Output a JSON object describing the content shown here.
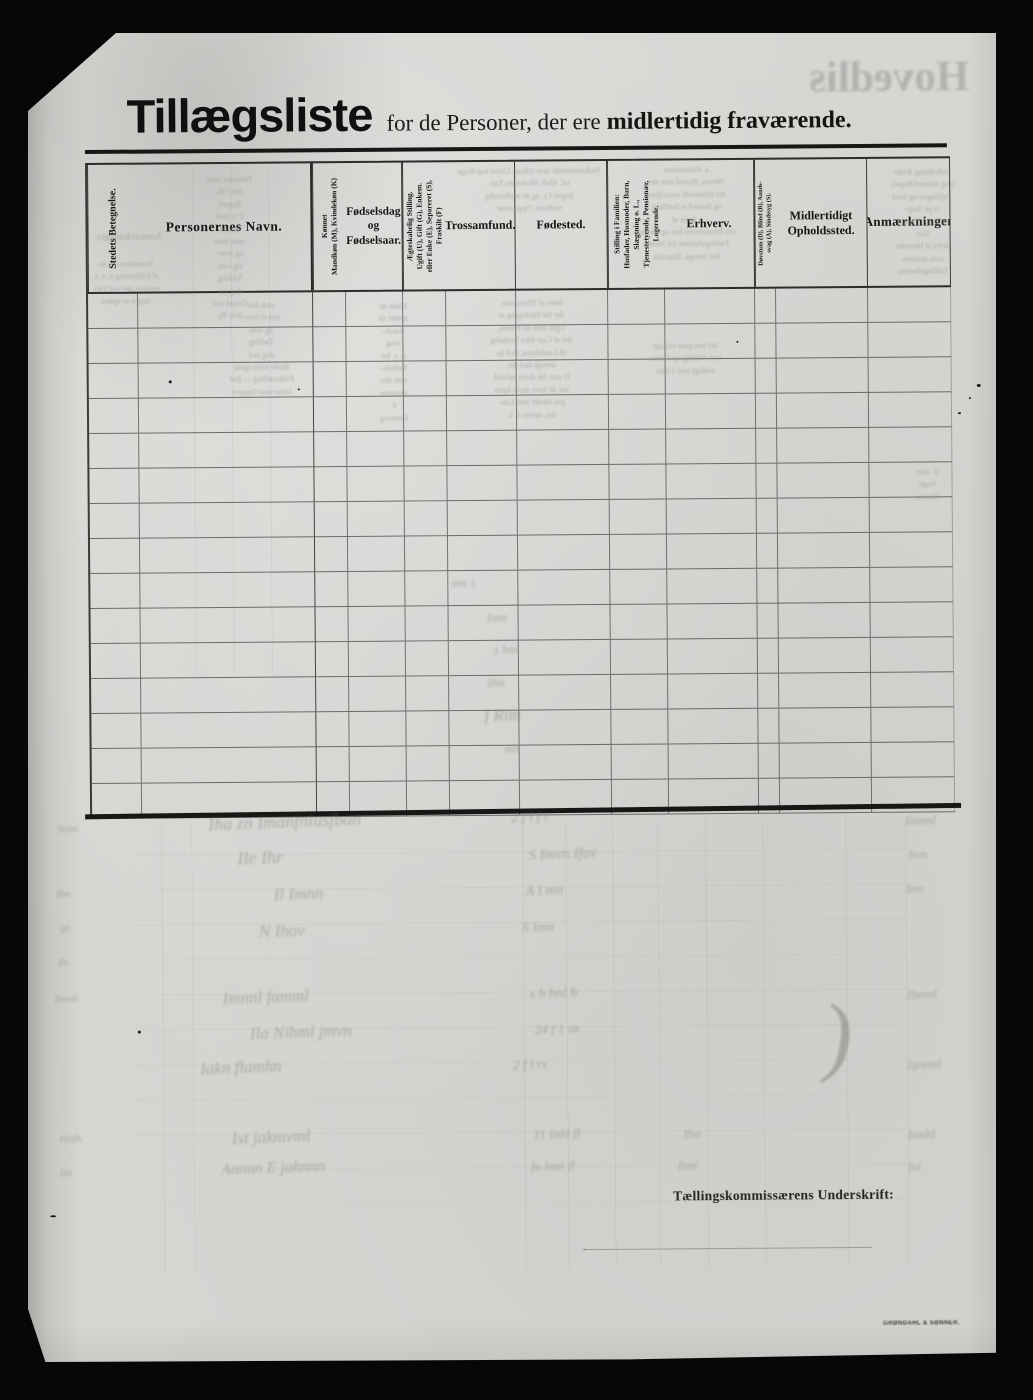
{
  "document": {
    "title": "Tillægsliste",
    "subtitle_regular": "for de Personer, der ere",
    "subtitle_bold": "midlertidig fraværende.",
    "footer": {
      "signature_label": "Tællingskommissærens Underskrift:",
      "printer_imprint": "GRØNDAHL & SØNNER."
    }
  },
  "table": {
    "body_rows": 15,
    "columns": [
      {
        "id": "stedets-betegnelse",
        "label": "Stedets Betegnelse."
      },
      {
        "id": "personernes-navn",
        "label": "Personernes Navn."
      },
      {
        "id": "kjonnet",
        "label": "Kønnet\nMandkøn (M), Kvindekøn (K)"
      },
      {
        "id": "fodselsdag",
        "label": "Fødselsdag\nog\nFødselsaar."
      },
      {
        "id": "aegteskabelig-stilling",
        "label": "Ægteskabelig Stilling.\nUgift (U), Gift (G), Enkem.\neller Enke (E), Separeret (S),\nFraskilt (F)"
      },
      {
        "id": "trossamfund",
        "label": "Trossamfund."
      },
      {
        "id": "fodested",
        "label": "Fødested."
      },
      {
        "id": "stilling-i-familien",
        "label": "Stilling i Familien:\nHusfader, Husmoder, Barn,\nSlægtning o. L.,\nTjenestetyende, Pensionær,\nLogerende."
      },
      {
        "id": "erhverv",
        "label": "Erhverv."
      },
      {
        "id": "dovstum",
        "label": "Døvstum (D), Blind (B), Aands-\nsvag (A), Sindssyg (S)."
      },
      {
        "id": "midlertidigt-opholdssted",
        "label": "Midlertidigt\nOpholdssted."
      },
      {
        "id": "anmaerkninger",
        "label": "Anmærkninger"
      }
    ]
  },
  "ghosts": {
    "big_mirrored_title": "Hovedliste",
    "blocks": [
      {
        "x": 122,
        "y": 142,
        "w": 158,
        "s": 8,
        "lines": [
          "Personer, som",
          "den Tid,",
          "Bopæl,",
          "f. v. med",
          "bosted",
          "som Sted",
          "og over-",
          "sig ved-",
          "Tælling",
          "dog om",
          "Grund ved",
          "dens By"
        ]
      },
      {
        "x": 40,
        "y": 196,
        "w": 120,
        "s": 11,
        "lines": [
          "Anmærkninger."
        ]
      },
      {
        "x": 38,
        "y": 226,
        "w": 118,
        "s": 8,
        "lines": [
          "Fornødent om de",
          "af Udflytning o. s. v.",
          "medens der ved Tæl-",
          "lingen er opført"
        ]
      },
      {
        "x": 168,
        "y": 268,
        "w": 128,
        "s": 8,
        "lines": [
          "som den",
          "nys er bort-",
          "og som",
          "Tælling",
          "dog ved",
          "Rinfo  Alen  ogsaa",
          "Folketælling  —  Del",
          "bleve  som  Opgave"
        ]
      },
      {
        "x": 318,
        "y": 270,
        "w": 92,
        "s": 8,
        "lines": [
          "Blade  de",
          "opføre  de",
          "Aands-",
          "svag",
          "d. v. for",
          "Fødsels-",
          "som  den",
          "sæsonen",
          "d.",
          "Førsteog"
        ]
      },
      {
        "x": 420,
        "y": 136,
        "w": 162,
        "s": 8,
        "lines": [
          "Vedkommende  dem  vilkaar  Listen  kan  Regn",
          "taf.  Midl.  Skolebørn  Tæl-",
          "lingen  f  s.  og  de  midlertidig",
          "vedkom.  Opgaverne"
        ]
      },
      {
        "x": 418,
        "y": 268,
        "w": 168,
        "s": 8,
        "lines": [
          "Børn  af  Tilreisende,",
          "der  for  Skolegang  er",
          "Ugift  eller  en  Person,",
          "der  af  Gaar  blev  henhørig",
          "til  Landsbyen,  hvil  ke",
          "iøvrigt  skal  der",
          "Ti  som  for  deres  ophold,",
          "bør  de  have  deres  hjem",
          "paa  Steder  som  Lan-",
          "det,  nævnt  d.  s."
        ]
      },
      {
        "x": 588,
        "y": 136,
        "w": 140,
        "s": 8,
        "lines": [
          "a.  Kolonnerne",
          "Skema,  Bosted  som  der",
          "der  tilhørende  mest  hjem",
          "og  Bosted  er  bortfaldt",
          "i  Byen  af",
          "om  Personernes  hos  og  Skema",
          "Tællingslisterne  fra  Skema",
          "Det  betegn.  Distrikts"
        ]
      },
      {
        "x": 592,
        "y": 312,
        "w": 128,
        "s": 8,
        "lines": [
          "der  betegnet  vedlagt",
          "som  Stilling  og  Skema",
          "vedlagt  som  Lister"
        ]
      },
      {
        "x": 838,
        "y": 140,
        "w": 112,
        "s": 8,
        "lines": [
          "Indledning,  Kirke",
          "a  og  dermed  Bopæl,",
          "Tællingen  og  Sted",
          "er  pr.  Sogn",
          "Stilling  i  Famil-",
          "Den",
          "deles  af  Herredet",
          "som  opførtes",
          "Tællingslisterne"
        ]
      },
      {
        "x": 852,
        "y": 440,
        "w": 90,
        "s": 8,
        "lines": [
          "d.  Ann",
          "Sogn",
          "Skema"
        ]
      }
    ],
    "strokes": [
      {
        "x": 175,
        "y": 780,
        "t": "Iha  zn  Imanfnlusfban",
        "s": 18
      },
      {
        "x": 478,
        "y": 781,
        "t": "2   f  l  f  r",
        "s": 14
      },
      {
        "x": 872,
        "y": 786,
        "t": "Imnnl",
        "s": 13
      },
      {
        "x": 204,
        "y": 816,
        "t": "Ile    Ihr",
        "s": 18
      },
      {
        "x": 495,
        "y": 817,
        "t": "S  Imvn   Ifov",
        "s": 15
      },
      {
        "x": 875,
        "y": 820,
        "t": "hvn",
        "s": 13
      },
      {
        "x": 240,
        "y": 853,
        "t": "Il   Imnn",
        "s": 17
      },
      {
        "x": 492,
        "y": 854,
        "t": "A   I mn",
        "s": 14
      },
      {
        "x": 872,
        "y": 855,
        "t": "Snn",
        "s": 12
      },
      {
        "x": 225,
        "y": 890,
        "t": "N    Ihov",
        "s": 17
      },
      {
        "x": 488,
        "y": 891,
        "t": "S  Imn",
        "s": 14
      },
      {
        "x": 420,
        "y": 545,
        "t": "mn  s",
        "s": 13
      },
      {
        "x": 455,
        "y": 580,
        "t": "Imn",
        "s": 13
      },
      {
        "x": 462,
        "y": 612,
        "t": "s hm",
        "s": 13
      },
      {
        "x": 455,
        "y": 645,
        "t": "Ihn",
        "s": 13
      },
      {
        "x": 452,
        "y": 676,
        "t": "f   Rim",
        "s": 17
      },
      {
        "x": 472,
        "y": 712,
        "t": "mn",
        "s": 12
      },
      {
        "x": 188,
        "y": 956,
        "t": "Imnnl    famml",
        "s": 17
      },
      {
        "x": 495,
        "y": 957,
        "t": "s  h  bnl   h",
        "s": 14
      },
      {
        "x": 872,
        "y": 960,
        "t": "Ibmnl",
        "s": 13
      },
      {
        "x": 215,
        "y": 991,
        "t": "Ila   Nihml   jmvn",
        "s": 17
      },
      {
        "x": 500,
        "y": 992,
        "t": "24 f  1 sn",
        "s": 13
      },
      {
        "x": 165,
        "y": 1026,
        "t": "Iakn     flamhn",
        "s": 17
      },
      {
        "x": 478,
        "y": 1027,
        "t": "2 f   l  rx",
        "s": 13
      },
      {
        "x": 872,
        "y": 1030,
        "t": "Ignnnl",
        "s": 13
      },
      {
        "x": 196,
        "y": 1096,
        "t": "Ist     jakmvml",
        "s": 17
      },
      {
        "x": 498,
        "y": 1097,
        "t": "11 Inhl   fl",
        "s": 13
      },
      {
        "x": 648,
        "y": 1098,
        "t": "Ihn",
        "s": 13
      },
      {
        "x": 872,
        "y": 1100,
        "t": "Innhl",
        "s": 13
      },
      {
        "x": 185,
        "y": 1128,
        "t": "Antmn  E   jahnnn",
        "s": 16
      },
      {
        "x": 495,
        "y": 1129,
        "t": "fn Imn   fl",
        "s": 13
      },
      {
        "x": 642,
        "y": 1130,
        "t": "Ihnl",
        "s": 12
      },
      {
        "x": 872,
        "y": 1133,
        "t": "Inl",
        "s": 12
      },
      {
        "x": 24,
        "y": 790,
        "t": "Nnm",
        "s": 11
      },
      {
        "x": 22,
        "y": 855,
        "t": "Ihn",
        "s": 11
      },
      {
        "x": 26,
        "y": 890,
        "t": "gn",
        "s": 10
      },
      {
        "x": 24,
        "y": 925,
        "t": "Ps",
        "s": 10
      },
      {
        "x": 20,
        "y": 960,
        "t": "Ihnnl",
        "s": 11
      },
      {
        "x": 24,
        "y": 1100,
        "t": "Hnfh",
        "s": 11
      },
      {
        "x": 24,
        "y": 1134,
        "t": "Iln",
        "s": 11
      },
      {
        "x": 788,
        "y": 958,
        "t": ")",
        "s": 88
      }
    ],
    "lines": [
      {
        "x": 164,
        "y": 135,
        "w": 1,
        "h": 505,
        "o": 0.1
      },
      {
        "x": 202,
        "y": 135,
        "w": 1,
        "h": 505,
        "o": 0.1
      },
      {
        "x": 240,
        "y": 135,
        "w": 1,
        "h": 505,
        "o": 0.09
      },
      {
        "x": 128,
        "y": 790,
        "w": 1,
        "h": 450,
        "o": 0.1
      },
      {
        "x": 158,
        "y": 790,
        "w": 1,
        "h": 450,
        "o": 0.08
      },
      {
        "x": 489,
        "y": 790,
        "w": 1,
        "h": 450,
        "o": 0.11
      },
      {
        "x": 532,
        "y": 790,
        "w": 1,
        "h": 450,
        "o": 0.09
      },
      {
        "x": 579,
        "y": 790,
        "w": 1,
        "h": 450,
        "o": 0.1
      },
      {
        "x": 624,
        "y": 790,
        "w": 1,
        "h": 450,
        "o": 0.08
      },
      {
        "x": 672,
        "y": 790,
        "w": 1,
        "h": 450,
        "o": 0.09
      },
      {
        "x": 729,
        "y": 790,
        "w": 1,
        "h": 450,
        "o": 0.08
      },
      {
        "x": 812,
        "y": 790,
        "w": 1,
        "h": 450,
        "o": 0.09
      },
      {
        "x": 872,
        "y": 790,
        "w": 1,
        "h": 450,
        "o": 0.08
      },
      {
        "x": 100,
        "y": 822,
        "w": 772,
        "h": 1,
        "o": 0.07
      },
      {
        "x": 100,
        "y": 857,
        "w": 772,
        "h": 1,
        "o": 0.07
      },
      {
        "x": 100,
        "y": 892,
        "w": 772,
        "h": 1,
        "o": 0.07
      },
      {
        "x": 100,
        "y": 927,
        "w": 772,
        "h": 1,
        "o": 0.06
      },
      {
        "x": 100,
        "y": 962,
        "w": 772,
        "h": 1,
        "o": 0.07
      },
      {
        "x": 100,
        "y": 997,
        "w": 772,
        "h": 1,
        "o": 0.07
      },
      {
        "x": 100,
        "y": 1032,
        "w": 772,
        "h": 1,
        "o": 0.06
      },
      {
        "x": 100,
        "y": 1067,
        "w": 772,
        "h": 1,
        "o": 0.06
      },
      {
        "x": 100,
        "y": 1102,
        "w": 772,
        "h": 1,
        "o": 0.07
      },
      {
        "x": 100,
        "y": 1137,
        "w": 772,
        "h": 1,
        "o": 0.06
      },
      {
        "x": 100,
        "y": 1172,
        "w": 772,
        "h": 1,
        "o": 0.05
      }
    ],
    "specks": [
      {
        "x": 139,
        "y": 348,
        "w": 3,
        "h": 3
      },
      {
        "x": 707,
        "y": 313,
        "w": 2,
        "h": 2
      },
      {
        "x": 268,
        "y": 357,
        "w": 2,
        "h": 2
      },
      {
        "x": 947,
        "y": 358,
        "w": 4,
        "h": 3
      },
      {
        "x": 939,
        "y": 371,
        "w": 2,
        "h": 2
      },
      {
        "x": 928,
        "y": 386,
        "w": 3,
        "h": 2
      },
      {
        "x": 103,
        "y": 998,
        "w": 3,
        "h": 3
      },
      {
        "x": 14,
        "y": 1182,
        "w": 6,
        "h": 2
      }
    ]
  }
}
